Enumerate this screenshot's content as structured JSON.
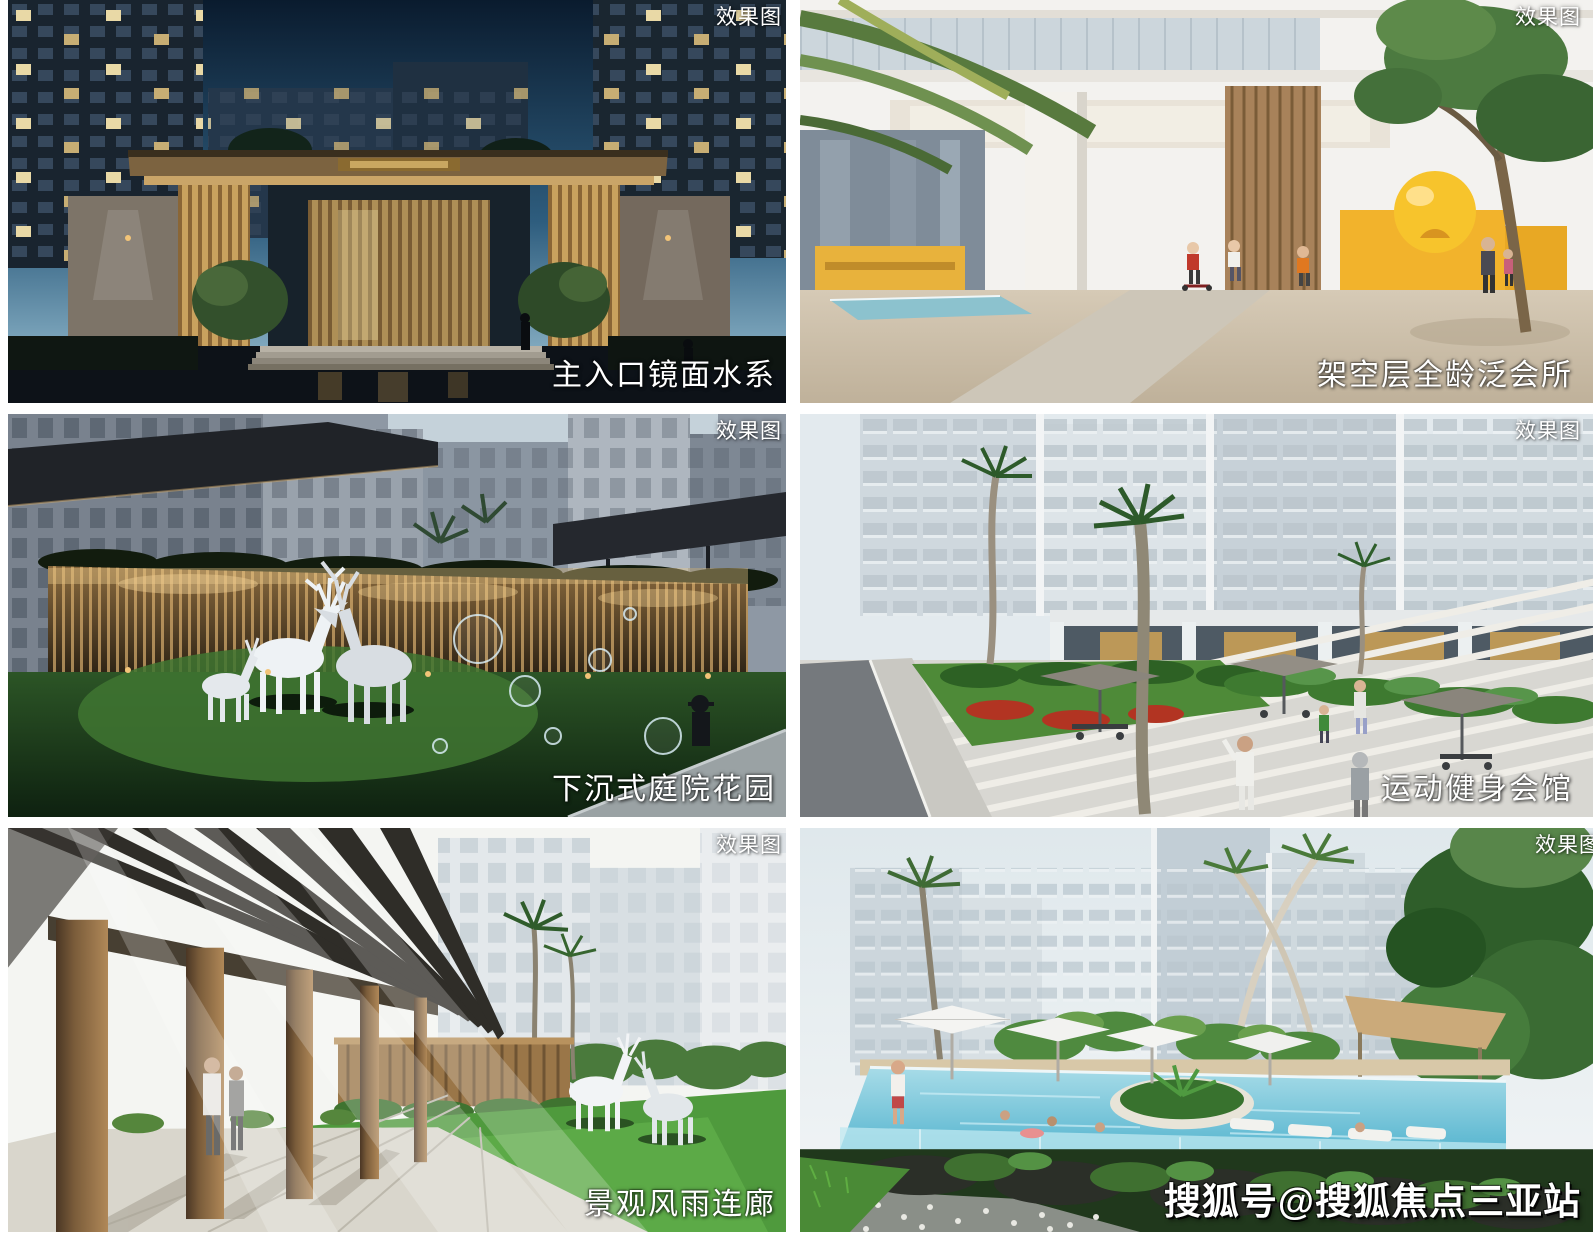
{
  "collage": {
    "badge_label": "效果图",
    "panels": [
      {
        "scene": "night-entrance-gate",
        "badge": "效果图",
        "caption": "主入口镜面水系"
      },
      {
        "scene": "stilt-floor-clubhouse",
        "badge": "效果图",
        "caption": "架空层全龄泛会所"
      },
      {
        "scene": "sunken-courtyard-garden",
        "badge": "效果图",
        "caption": "下沉式庭院花园"
      },
      {
        "scene": "sports-fitness-club-plaza",
        "badge": "效果图",
        "caption": "运动健身会馆"
      },
      {
        "scene": "covered-landscape-corridor",
        "badge": "效果图",
        "caption": "景观风雨连廊"
      },
      {
        "scene": "resort-swimming-pool",
        "badge": "效果图",
        "watermark": "搜狐号@搜狐焦点三亚站"
      }
    ]
  },
  "colors": {
    "background": "#ffffff",
    "label_text": "#ffffff",
    "night_sky": "#0a1b2e",
    "gold_accent": "#c9a25e",
    "yellow_accent": "#f2b32c",
    "lawn_green": "#4f9a3d",
    "pool_teal": "#5cb8d0"
  }
}
